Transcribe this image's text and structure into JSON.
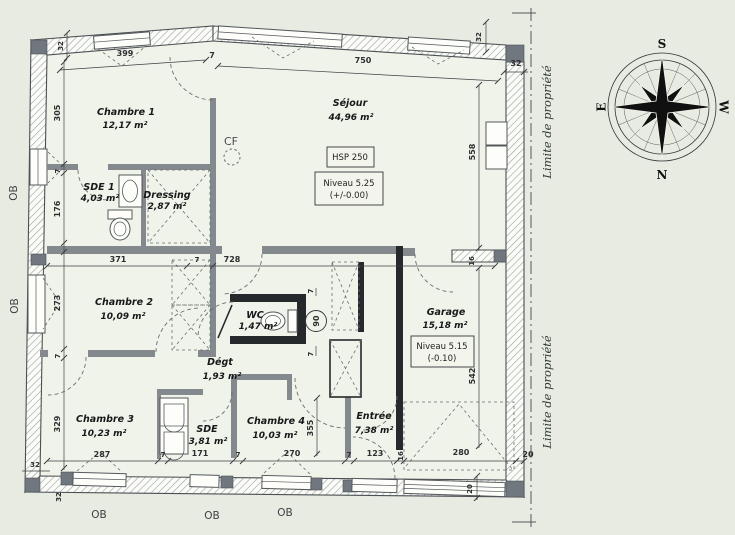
{
  "plan": {
    "rooms": [
      {
        "name": "Chambre 1",
        "area": "12,17 m²"
      },
      {
        "name": "SDE 1",
        "area": "4,03 m²"
      },
      {
        "name": "Dressing",
        "area": "2,87 m²"
      },
      {
        "name": "Séjour",
        "area": "44,96 m²"
      },
      {
        "name": "Chambre 2",
        "area": "10,09 m²"
      },
      {
        "name": "WC",
        "area": "1,47 m²"
      },
      {
        "name": "Garage",
        "area": "15,18 m²"
      },
      {
        "name": "Dégt",
        "area": "1,93 m²"
      },
      {
        "name": "Chambre 3",
        "area": "10,23 m²"
      },
      {
        "name": "SDE",
        "area": "3,81 m²"
      },
      {
        "name": "Chambre 4",
        "area": "10,03 m²"
      },
      {
        "name": "Entrée",
        "area": "7,38 m²"
      }
    ],
    "annotations": {
      "cf": "CF",
      "hsp": "HSP 250",
      "niveau_sejour": "Niveau 5.25",
      "niveau_sejour_ref": "(+/-0.00)",
      "niveau_garage": "Niveau 5.15",
      "niveau_garage_ref": "(-0.10)",
      "limite": "Limite de propriété",
      "ob": "OB",
      "door_diameter": "90"
    },
    "dimensions": {
      "top_chambre1": "399",
      "top_sejour": "750",
      "left_chambre1": "305",
      "left_sde1": "176",
      "left_chambre2": "273",
      "left_chambre3": "329",
      "inner_chambre2": "371",
      "inner_sejour": "728",
      "right_sejour": "558",
      "right_garage": "542",
      "mid_entree": "355",
      "bottom_chambre3": "287",
      "bottom_sde": "171",
      "bottom_chambre4": "270",
      "bottom_entree": "123",
      "bottom_garage_door": "280",
      "wall7": "7",
      "wall16": "16",
      "wall20": "20",
      "wall32": "32"
    },
    "compass": {
      "top": "S",
      "bottom": "N",
      "left": "E",
      "right": "W"
    },
    "colors": {
      "paper": "#e7ebe2",
      "floor": "#f0f3ea",
      "wall_dark": "#26292c",
      "ink": "#26282a"
    }
  }
}
